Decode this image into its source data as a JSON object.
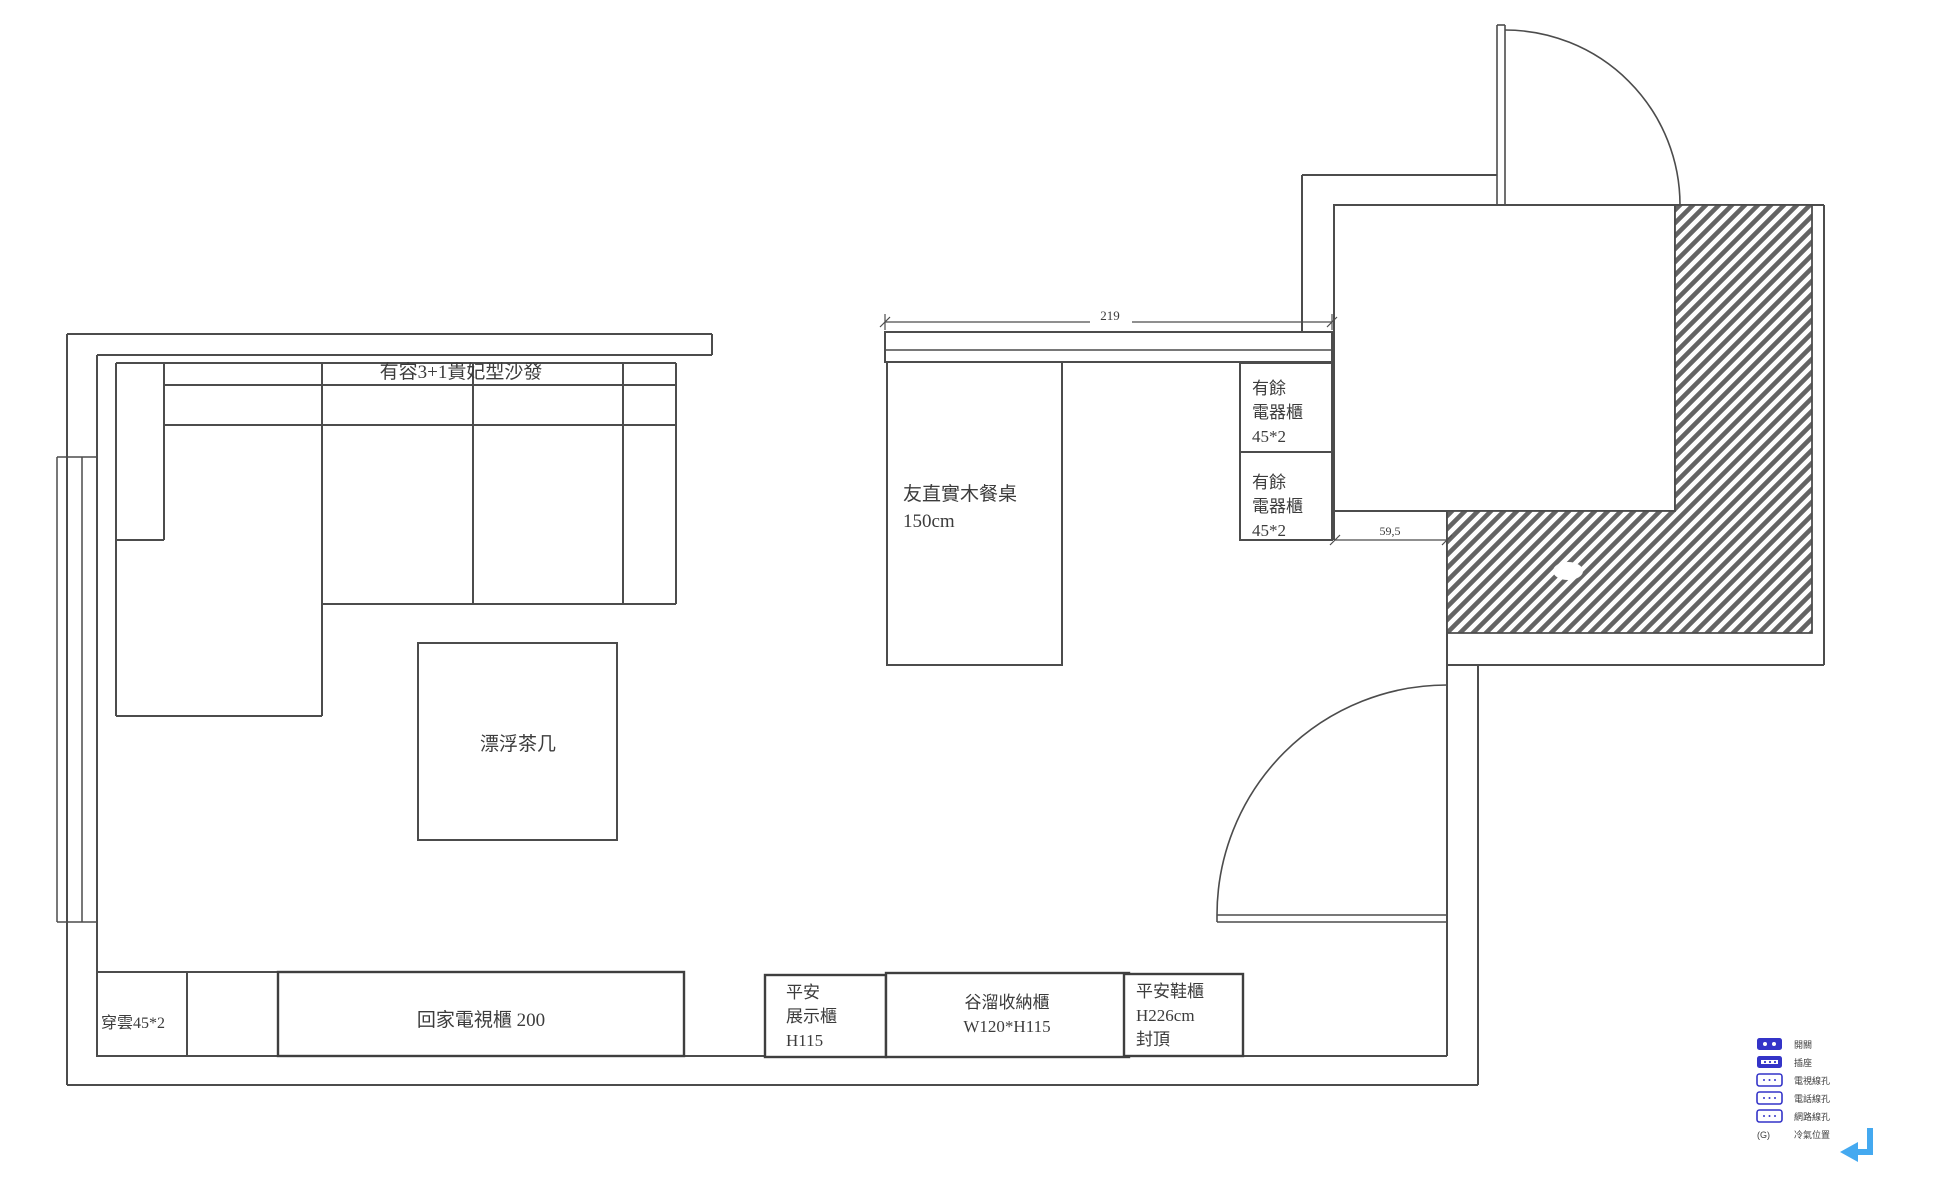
{
  "page": {
    "background": "#ffffff"
  },
  "plan": {
    "labels": {
      "sofa": "有容3+1貴妃型沙發",
      "coffee_table": "漂浮茶几",
      "dining_table_line1": "友直實木餐桌",
      "dining_table_line2": "150cm",
      "appliance_cabinet_upper_line1": "有餘",
      "appliance_cabinet_upper_line2": "電器櫃",
      "appliance_cabinet_upper_line3": "45*2",
      "appliance_cabinet_lower_line1": "有餘",
      "appliance_cabinet_lower_line2": "電器櫃",
      "appliance_cabinet_lower_line3": "45*2",
      "side_cabinet": "穿雲45*2",
      "tv_cabinet": "回家電視櫃 200",
      "display_cabinet_line1": "平安",
      "display_cabinet_line2": "展示櫃",
      "display_cabinet_line3": "H115",
      "storage_cabinet_line1": "谷溜收納櫃",
      "storage_cabinet_line2": "W120*H115",
      "shoe_cabinet_line1": "平安鞋櫃",
      "shoe_cabinet_line2": "H226cm",
      "shoe_cabinet_line3": "封頂"
    },
    "dimensions": {
      "counter_width": "219",
      "gap_width": "59,5"
    }
  },
  "legend": {
    "items": [
      {
        "icon": "switch-icon",
        "label": "開關"
      },
      {
        "icon": "outlet-icon",
        "label": "插座"
      },
      {
        "icon": "tv-jack-icon",
        "label": "電視線孔"
      },
      {
        "icon": "phone-jack-icon",
        "label": "電話線孔"
      },
      {
        "icon": "network-jack-icon",
        "label": "網路線孔"
      },
      {
        "icon": "ac-icon",
        "icon_text": "(G)",
        "label": "冷氣位置"
      }
    ]
  },
  "colors": {
    "line": "#4c4c4c",
    "text": "#3c3c3c",
    "legend_blue": "#3434c8",
    "arrow_blue": "#44a9f0"
  }
}
